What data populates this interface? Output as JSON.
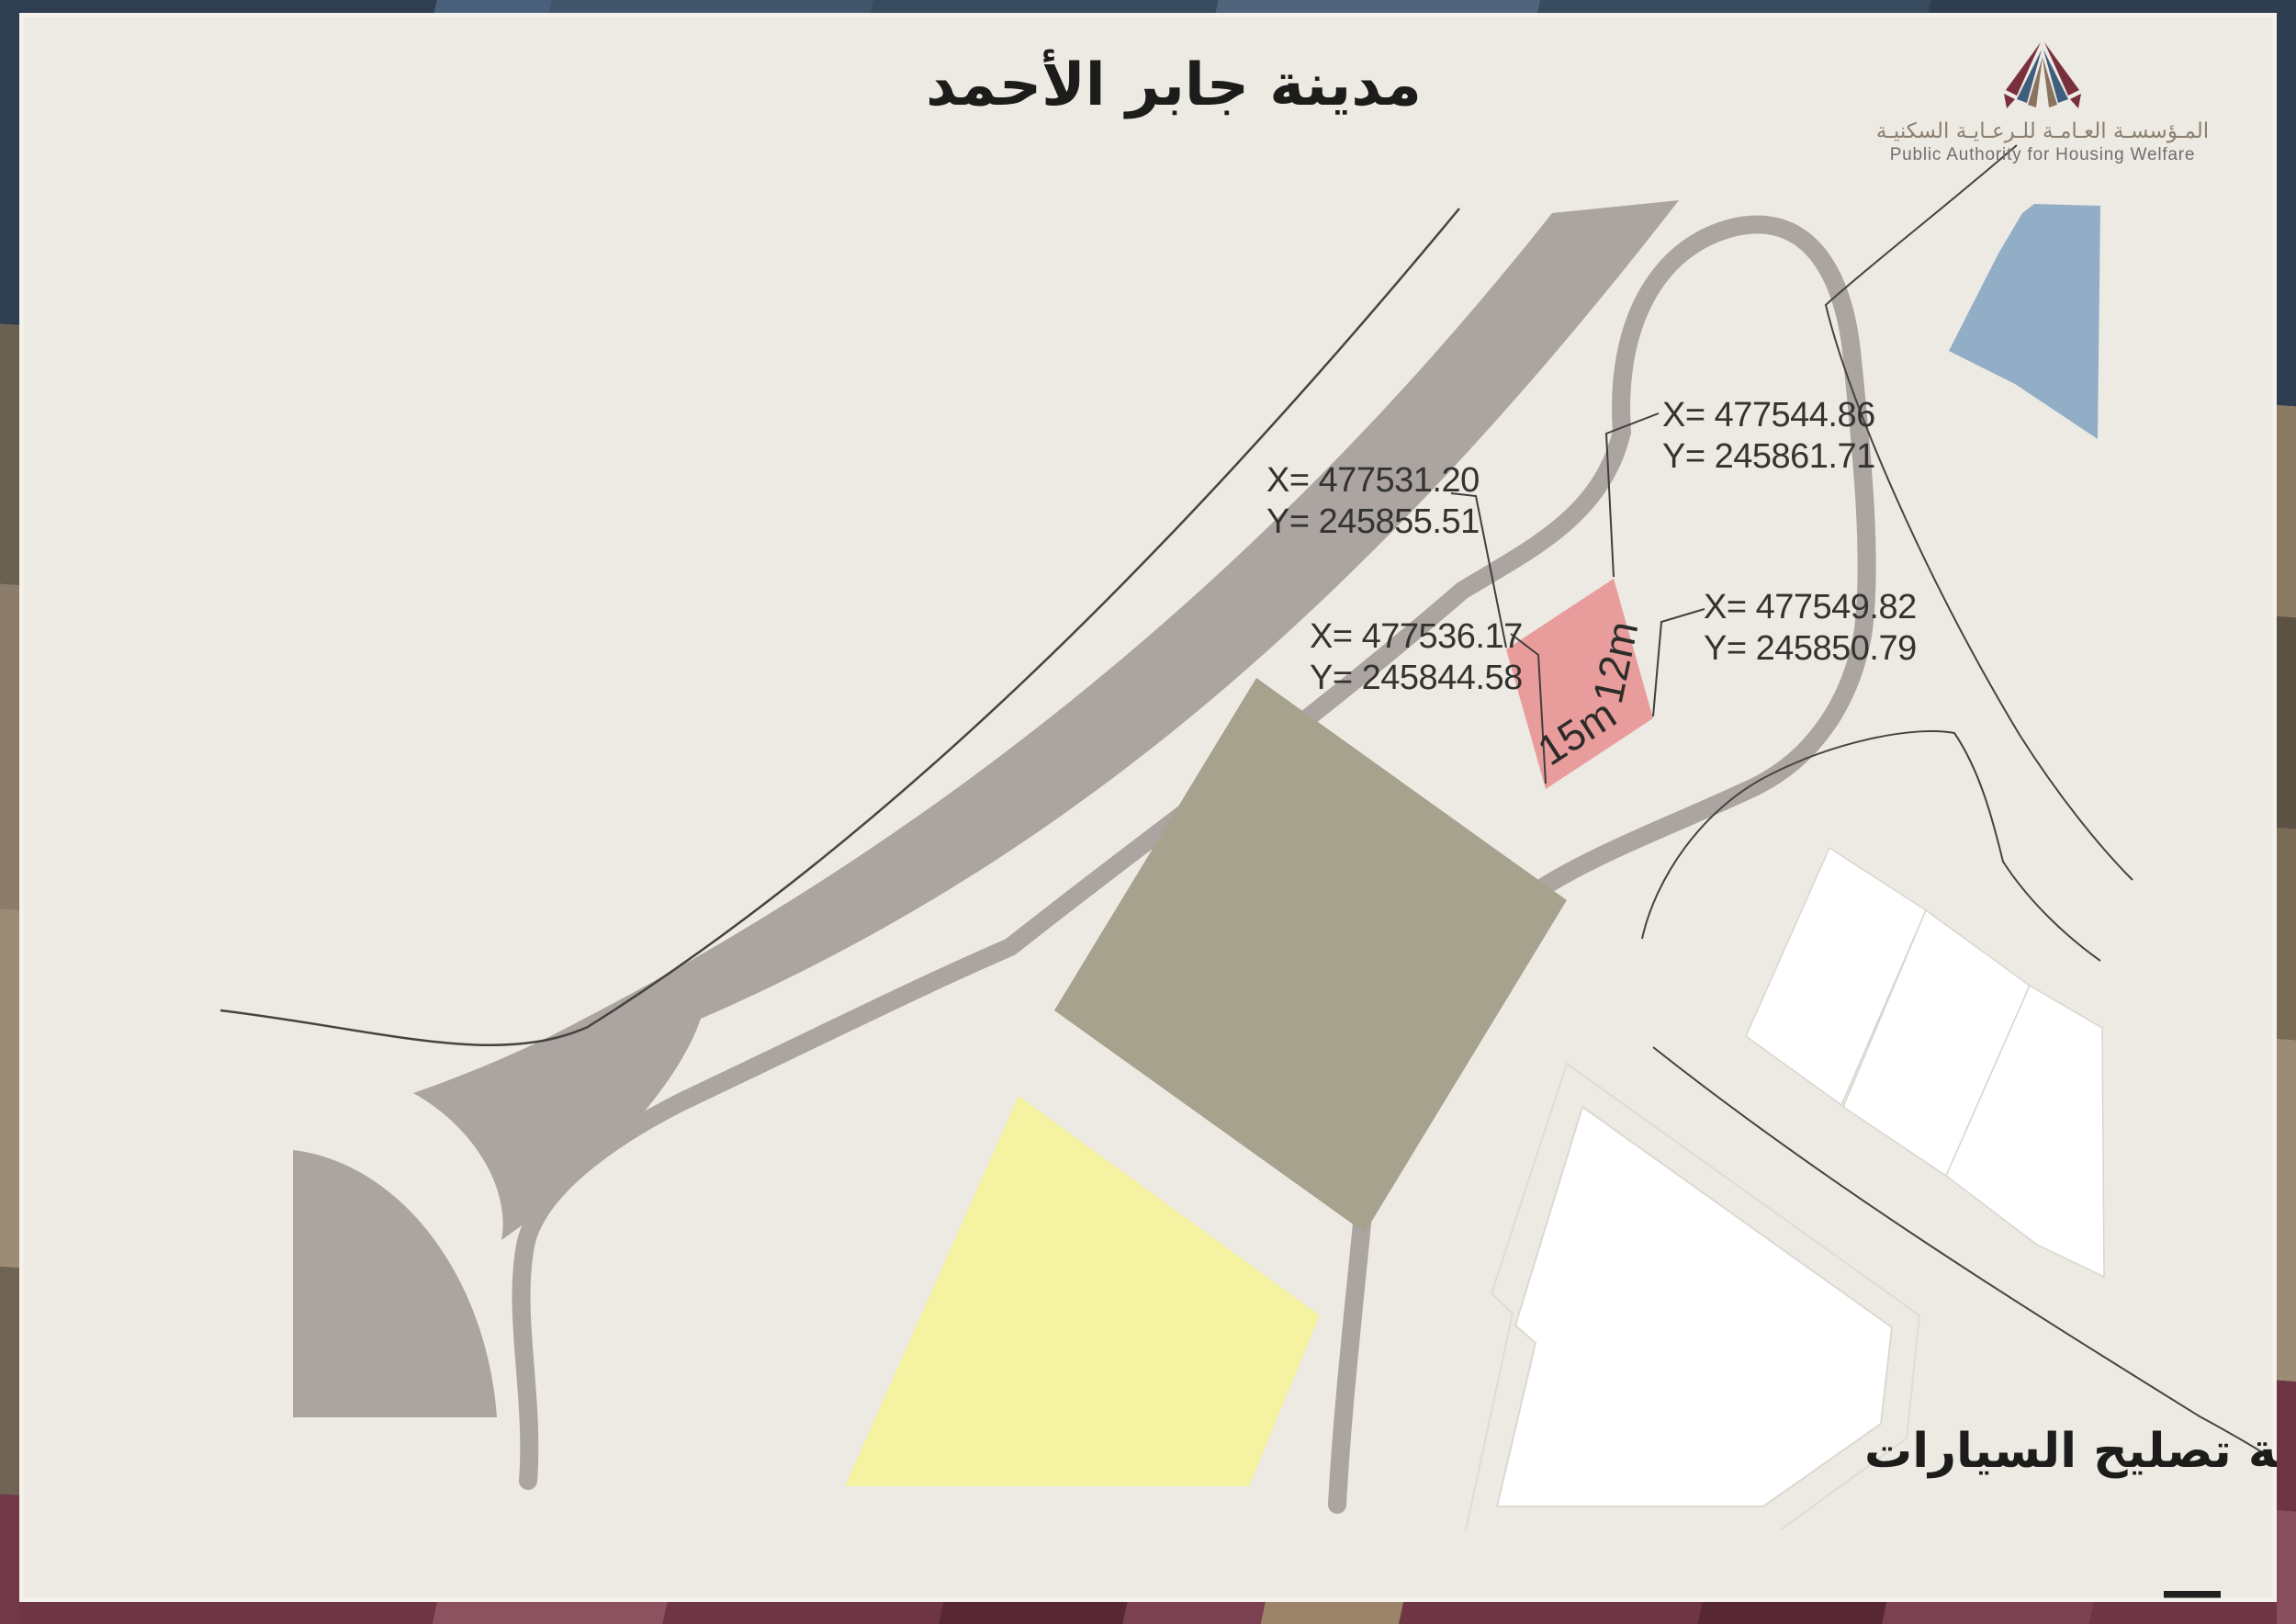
{
  "title": "مدينة جابر الأحمد",
  "logo": {
    "name_ar": "المـؤسسـة العـامـة للـرعـايـة السكنيـة",
    "name_en": "Public Authority for Housing Welfare"
  },
  "map": {
    "site_label": "ورشة تصليح السيارات",
    "plot": {
      "width_label": "15m",
      "height_label": "12m",
      "corner_top": {
        "x": "X= 477544.86",
        "y": "Y= 245861.71"
      },
      "corner_left": {
        "x": "X= 477531.20",
        "y": "Y= 245855.51"
      },
      "corner_bottom": {
        "x": "X= 477536.17",
        "y": "Y= 245844.58"
      },
      "corner_right": {
        "x": "X= 477549.82",
        "y": "Y= 245850.79"
      }
    }
  },
  "colors": {
    "page_bg": "#EDE9E3",
    "road_gray": "#ABA4A0",
    "plot_fill": "#E99C9C",
    "building_olive": "#A7A28E",
    "building_yellow": "#F5F2A1",
    "building_white": "#FFFFFF",
    "water_blue": "#92AEC6",
    "line_dark": "#45443F",
    "logo_maroon": "#7A2F3D",
    "logo_blue": "#3F5E7E",
    "logo_tan": "#8A7460"
  }
}
